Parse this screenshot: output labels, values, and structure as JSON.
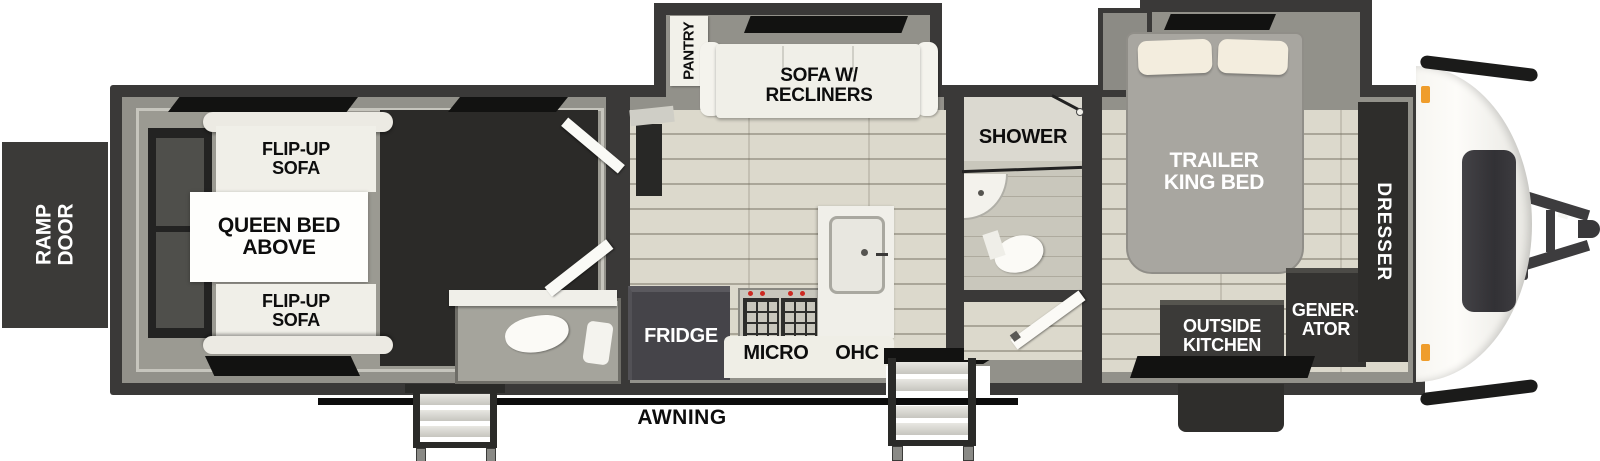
{
  "title": "Toy hauler travel trailer floorplan",
  "colors": {
    "wall": "#3a3938",
    "wall_fill": "#92918a",
    "floor_plank": "#dcd9cc",
    "garage_floor": "#2b2a28",
    "window_black": "#121211",
    "furniture_white": "#f0efe8",
    "dark_box": "#3b3a38",
    "bed_gray": "#a8a6a0",
    "pillow_cream": "#f3edde",
    "marker_light_orange": "#ef9d2c",
    "awning_black": "#0c0c0c"
  },
  "rear": {
    "ramp_door_label": "RAMP\nDOOR"
  },
  "garage": {
    "flip_up_sofa_top_label": "FLIP-UP\nSOFA",
    "queen_bed_label": "QUEEN BED\nABOVE",
    "flip_up_sofa_bottom_label": "FLIP-UP\nSOFA"
  },
  "living": {
    "pantry_label": "PANTRY",
    "sofa_label": "SOFA W/\nRECLINERS"
  },
  "kitchen": {
    "fridge_label": "FRIDGE",
    "micro_label": "MICRO",
    "ohc_label": "OHC"
  },
  "bathroom": {
    "shower_label": "SHOWER"
  },
  "bedroom": {
    "bed_label": "TRAILER\nKING BED",
    "dresser_label": "DRESSER",
    "outside_kitchen_label": "OUTSIDE\nKITCHEN",
    "generator_label": "GENER-\nATOR"
  },
  "exterior": {
    "awning_label": "AWNING"
  }
}
